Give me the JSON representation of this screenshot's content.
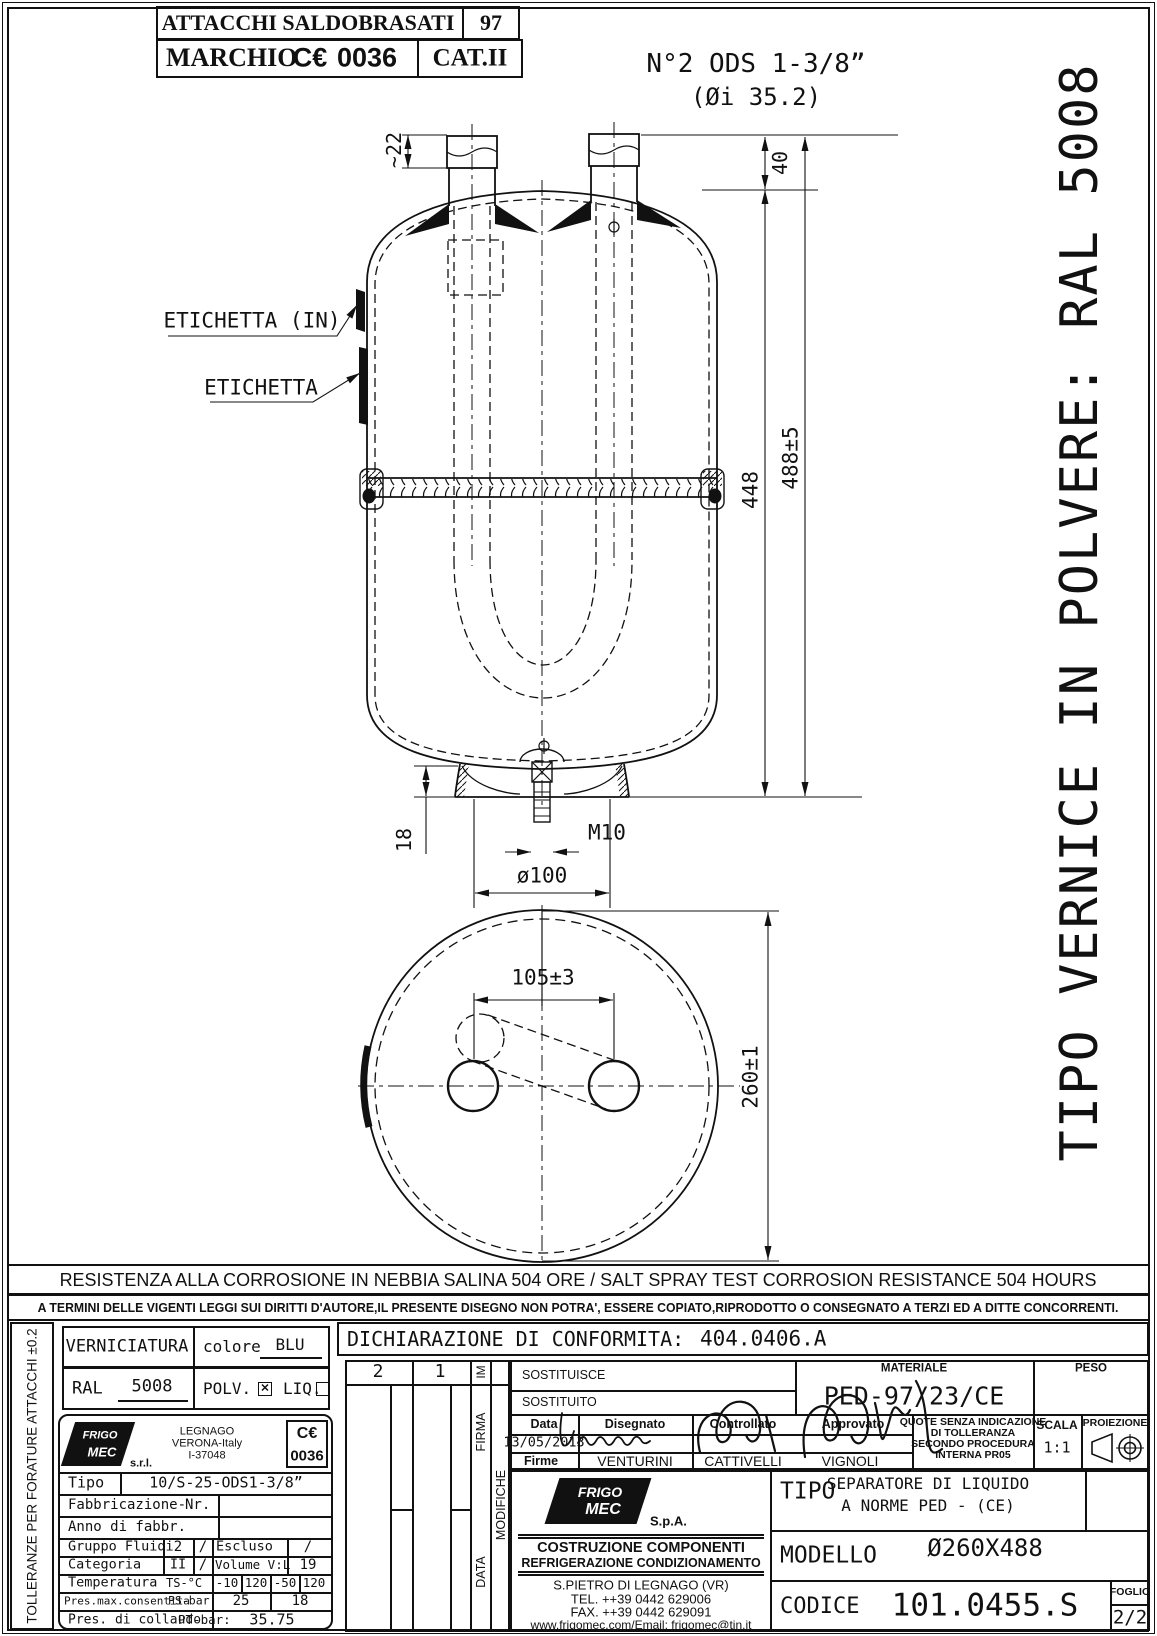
{
  "header": {
    "row1_title": "ATTACCHI SALDOBRASATI",
    "row1_num": "97",
    "row2_marchio": "MARCHIO",
    "ce_glyph": "C€",
    "ce_number": "0036",
    "cat": "CAT.II"
  },
  "side_note": "TIPO VERNICE IN POLVERE:  RAL 5008",
  "left_note": "TOLLERANZE PER FORATURE ATTACCHI ±0.2",
  "drawing": {
    "ods_line1": "N°2 ODS 1-3/8”",
    "ods_line2": "(Øi 35.2)",
    "dim_tube": "~22",
    "dim_40": "40",
    "dim_448": "448",
    "dim_488": "488±5",
    "etichetta_in": "ETICHETTA (IN)",
    "etichetta": "ETICHETTA",
    "dim_18": "18",
    "m10": "M10",
    "d100": "ø100",
    "plan_105": "105±3",
    "plan_260": "260±1"
  },
  "banner": {
    "resistance": "RESISTENZA ALLA CORROSIONE IN NEBBIA SALINA 504 ORE / SALT SPRAY TEST CORROSION RESISTANCE 504 HOURS",
    "copyright": "A TERMINI DELLE VIGENTI LEGGI SUI DIRITTI D'AUTORE,IL PRESENTE DISEGNO NON POTRA', ESSERE COPIATO,RIPRODOTTO O CONSEGNATO A TERZI ED A DITTE CONCORRENTI."
  },
  "paint": {
    "verniciatura": "VERNICIATURA",
    "colore_label": "colore",
    "colore_value": "BLU",
    "ral_label": "RAL",
    "ral_value": "5008",
    "polv_label": "POLV.",
    "polv_mark": "✕",
    "liq_label": "LIQ."
  },
  "nameplate": {
    "logo_line1": "FRIGO",
    "logo_line2": "MEC",
    "srl": "s.r.l.",
    "city": "LEGNAGO",
    "region": "VERONA-Italy",
    "zip": "I-37048",
    "ce_glyph": "C€",
    "ce_number": "0036",
    "tipo_label": "Tipo",
    "tipo_value": "10/S-25-ODS1-3/8”",
    "fabbricazione_label": "Fabbricazione-",
    "nr_label": "Nr.",
    "anno_label": "Anno di fabbr.",
    "gruppo_label": "Gruppo Fluidi",
    "gruppo_value": "2",
    "gruppo_slash": "/",
    "escluso_label": "Escluso",
    "escluso_value": "/",
    "categoria_label": "Categoria",
    "categoria_value": "II",
    "categoria_slash": "/",
    "volume_label": "Volume V:L",
    "volume_value": "19",
    "temperatura_label": "Temperatura",
    "ts_label": "TS-°C",
    "t1": "-10",
    "t2": "120",
    "t3": "-50",
    "t4": "120",
    "presmax_label": "Pres.max.consentita",
    "ps_label": "PS-bar:",
    "ps_v1": "25",
    "ps_v2": "18",
    "collaudo_label": "Pres. di collaudo",
    "pt_label": "PT-bar:",
    "pt_value": "35.75"
  },
  "conformity": {
    "label": "DICHIARAZIONE DI CONFORMITA:",
    "value": "404.0406.A"
  },
  "revision": {
    "col2": "2",
    "col1": "1",
    "im": "IM",
    "firma": "FIRMA",
    "modifiche": "MODIFICHE",
    "data": "DATA"
  },
  "approval": {
    "sostituisce": "SOSTITUISCE",
    "sostituito": "SOSTITUITO",
    "materiale_label": "MATERIALE",
    "materiale_value": "PED-97/23/CE",
    "peso_label": "PESO",
    "data_label": "Data",
    "data_value": "13/05/2013",
    "disegnato_label": "Disegnato",
    "controllato_label": "Controllato",
    "approvato_label": "Approvato",
    "firme_label": "Firme",
    "disegnato_name": "VENTURINI",
    "controllato_name": "CATTIVELLI",
    "approvato_name": "VIGNOLI",
    "note_line1": "QUOTE SENZA INDICAZIONE",
    "note_line2": "DI TOLLERANZA",
    "note_line3": "SECONDO PROCEDURA",
    "note_line4": "INTERNA PR05",
    "scala_label": "SCALA",
    "scala_value": "1:1",
    "proiezione_label": "PROIEZIONE"
  },
  "company": {
    "logo_line1": "FRIGO",
    "logo_line2": "MEC",
    "spa": "S.p.A.",
    "line1": "COSTRUZIONE COMPONENTI",
    "line2": "REFRIGERAZIONE CONDIZIONAMENTO",
    "line3": "S.PIETRO DI LEGNAGO (VR)",
    "tel": "TEL. ++39 0442 629006",
    "fax": "FAX. ++39 0442 629091",
    "web": "www.frigomec.com/Email: frigomec@tin.it"
  },
  "product": {
    "tipo_label": "TIPO",
    "tipo_line1": "SEPARATORE DI LIQUIDO",
    "tipo_line2": "A  NORME PED - (CE)",
    "modello_label": "MODELLO",
    "modello_value": "Ø260X488",
    "codice_label": "CODICE",
    "codice_value": "101.0455.S",
    "foglio_label": "FOGLIO",
    "foglio_value": "2/2"
  }
}
